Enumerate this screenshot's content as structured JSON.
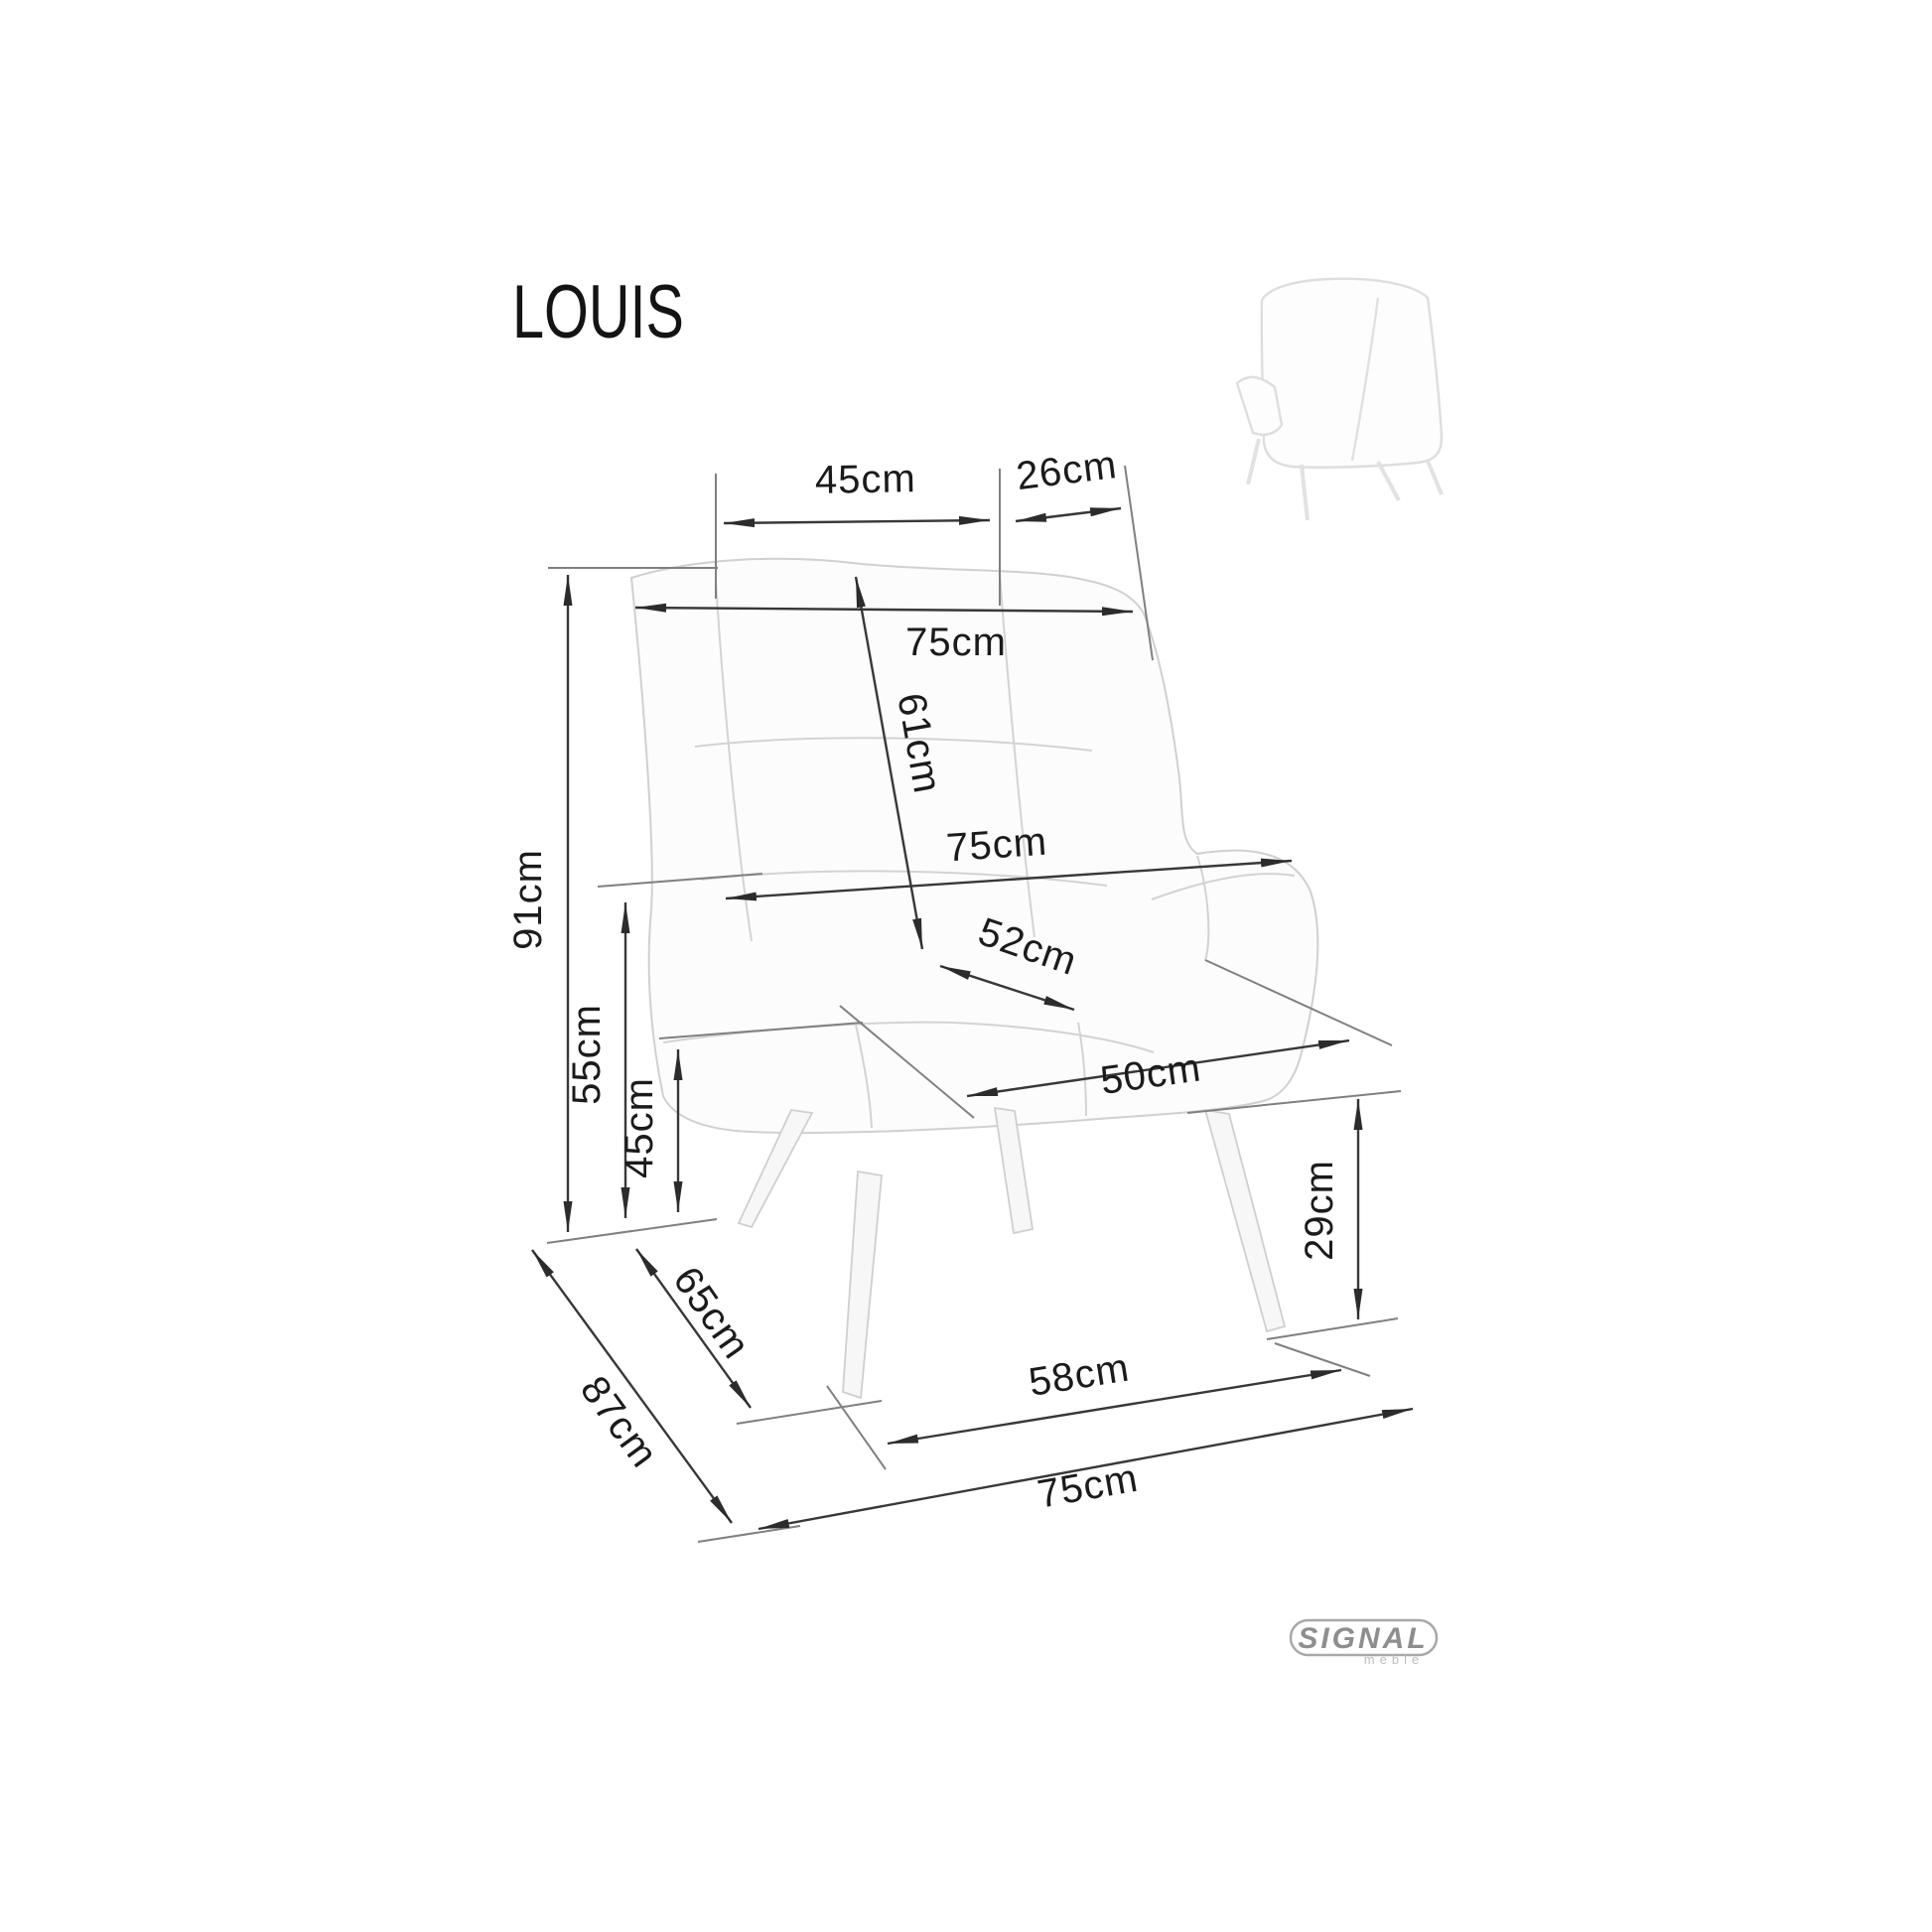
{
  "title": "LOUIS",
  "logo": {
    "brand": "SIGNAL",
    "sub": "meble"
  },
  "dimensions": {
    "backrest_top_width": {
      "label": "45cm",
      "value": 45
    },
    "wing_top_width": {
      "label": "26cm",
      "value": 26
    },
    "overall_width_top": {
      "label": "75cm",
      "value": 75
    },
    "backrest_height": {
      "label": "61cm",
      "value": 61
    },
    "total_height": {
      "label": "91cm",
      "value": 91
    },
    "overall_width_mid": {
      "label": "75cm",
      "value": 75
    },
    "seat_depth": {
      "label": "52cm",
      "value": 52
    },
    "seat_width": {
      "label": "50cm",
      "value": 50
    },
    "armrest_height": {
      "label": "55cm",
      "value": 55
    },
    "seat_height": {
      "label": "45cm",
      "value": 45
    },
    "leg_span_depth": {
      "label": "65cm",
      "value": 65
    },
    "overall_depth": {
      "label": "87cm",
      "value": 87
    },
    "leg_height": {
      "label": "29cm",
      "value": 29
    },
    "front_leg_span": {
      "label": "58cm",
      "value": 58
    },
    "overall_width_floor": {
      "label": "75cm",
      "value": 75
    }
  }
}
